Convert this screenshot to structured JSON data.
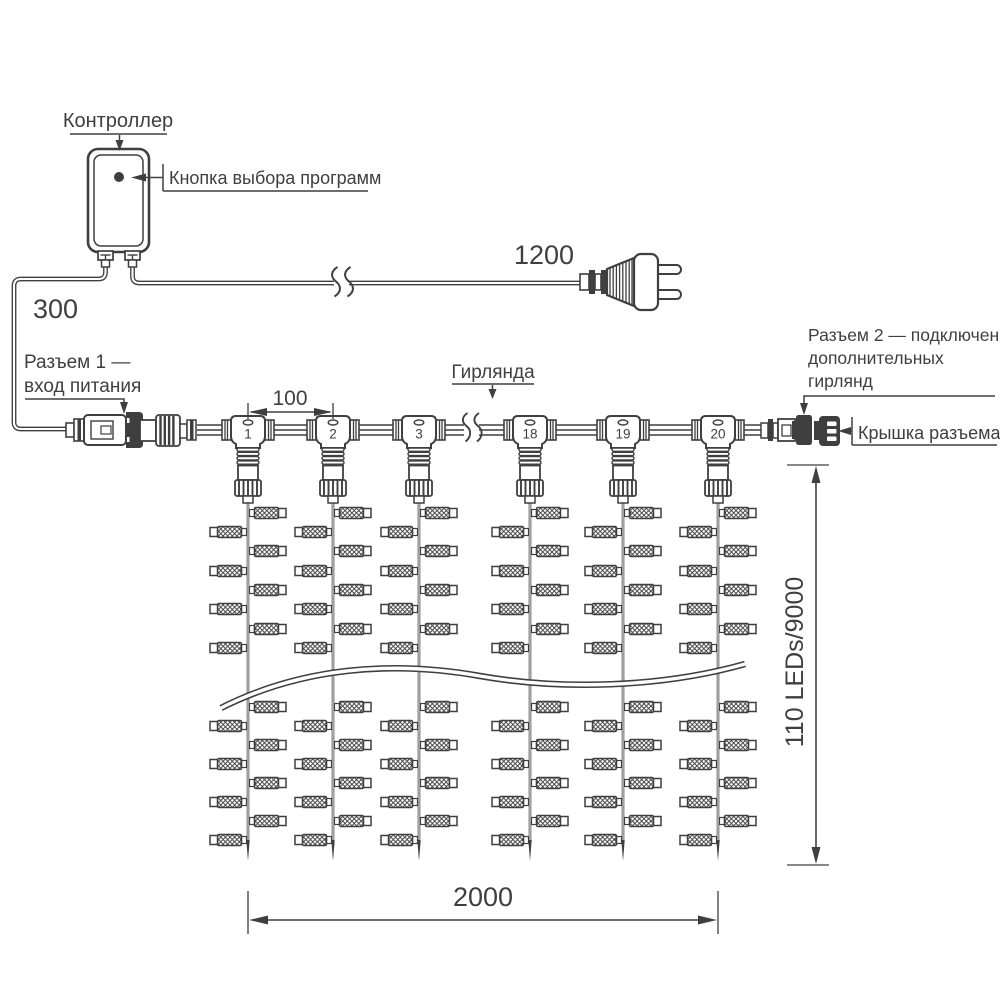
{
  "diagram": {
    "labels": {
      "controller": "Контроллер",
      "program_button": "Кнопка выбора программ",
      "connector1_line1": "Разъем 1 —",
      "connector1_line2": "вход питания",
      "garland": "Гирлянда",
      "connector2_line1": "Разъем 2 — подключение",
      "connector2_line2": "дополнительных",
      "connector2_line3": "гирлянд",
      "cap": "Крышка разъема"
    },
    "dimensions": {
      "power_input_wire": "300",
      "power_cord": "1200",
      "drop_spacing": "100",
      "curtain_width": "2000",
      "curtain_height": "110 LEDs/9000"
    },
    "connectors": [
      "1",
      "2",
      "3",
      "18",
      "19",
      "20"
    ],
    "strand_count": 6,
    "leds_per_strand_shown": 16
  }
}
